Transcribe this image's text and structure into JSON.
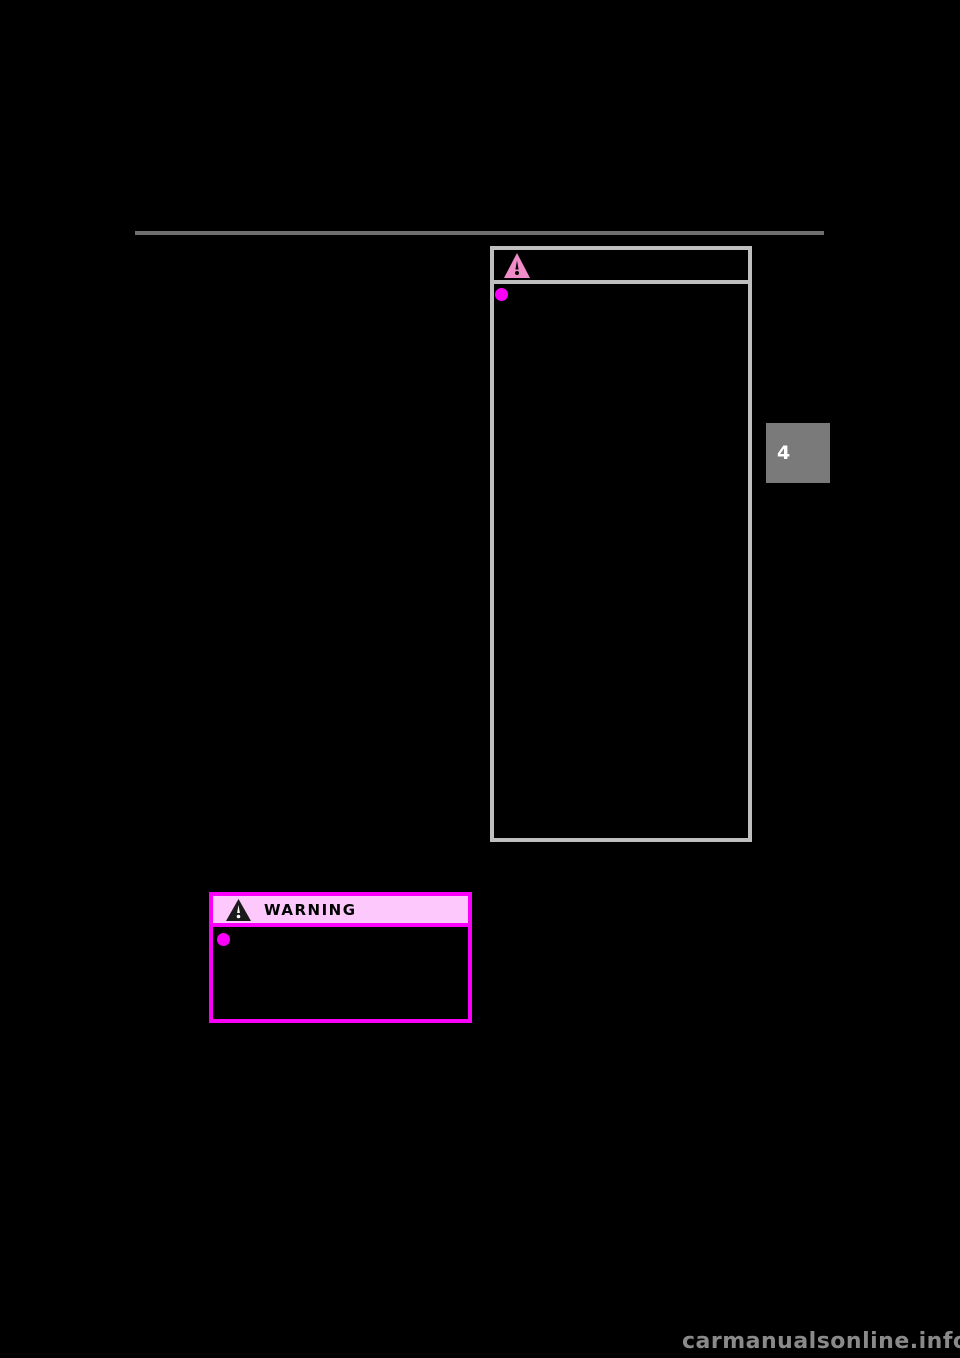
{
  "page": {
    "background_color": "#000000"
  },
  "top_rule": {
    "color": "#6e6e6e"
  },
  "caution_box": {
    "border_color": "#bfbfbf",
    "icon": "warning-triangle-icon",
    "icon_color": "#f08cc8",
    "bullet_color": "#fa00fa"
  },
  "chapter_tab": {
    "label": "4",
    "background_color": "#7a7a7a",
    "text_color": "#ffffff"
  },
  "warning_box": {
    "title": "WARNING",
    "border_color": "#fa00fa",
    "header_background_color": "#fdc9fc",
    "title_color": "#000000",
    "icon": "warning-triangle-icon",
    "icon_triangle_color": "#1a1a1a",
    "icon_exclamation_color": "#ffffff",
    "bullet_color": "#fa00fa"
  },
  "watermark": {
    "text": "carmanualsonline.info",
    "color": "#8a8a8a"
  }
}
